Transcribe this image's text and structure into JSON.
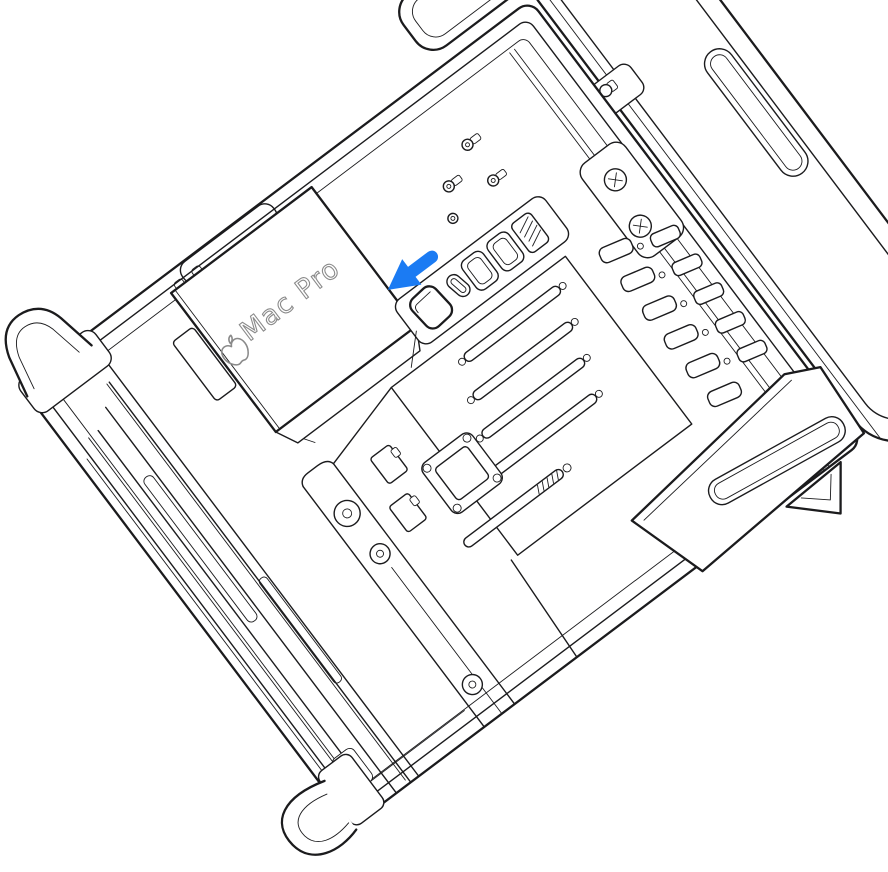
{
  "illustration": {
    "device_label": "Mac Pro",
    "arrow": {
      "color": "#1b7bf3",
      "direction": "down-left"
    },
    "colors": {
      "background": "#ffffff",
      "line": "#1b1b1d",
      "label": "#8a8a8a"
    }
  }
}
